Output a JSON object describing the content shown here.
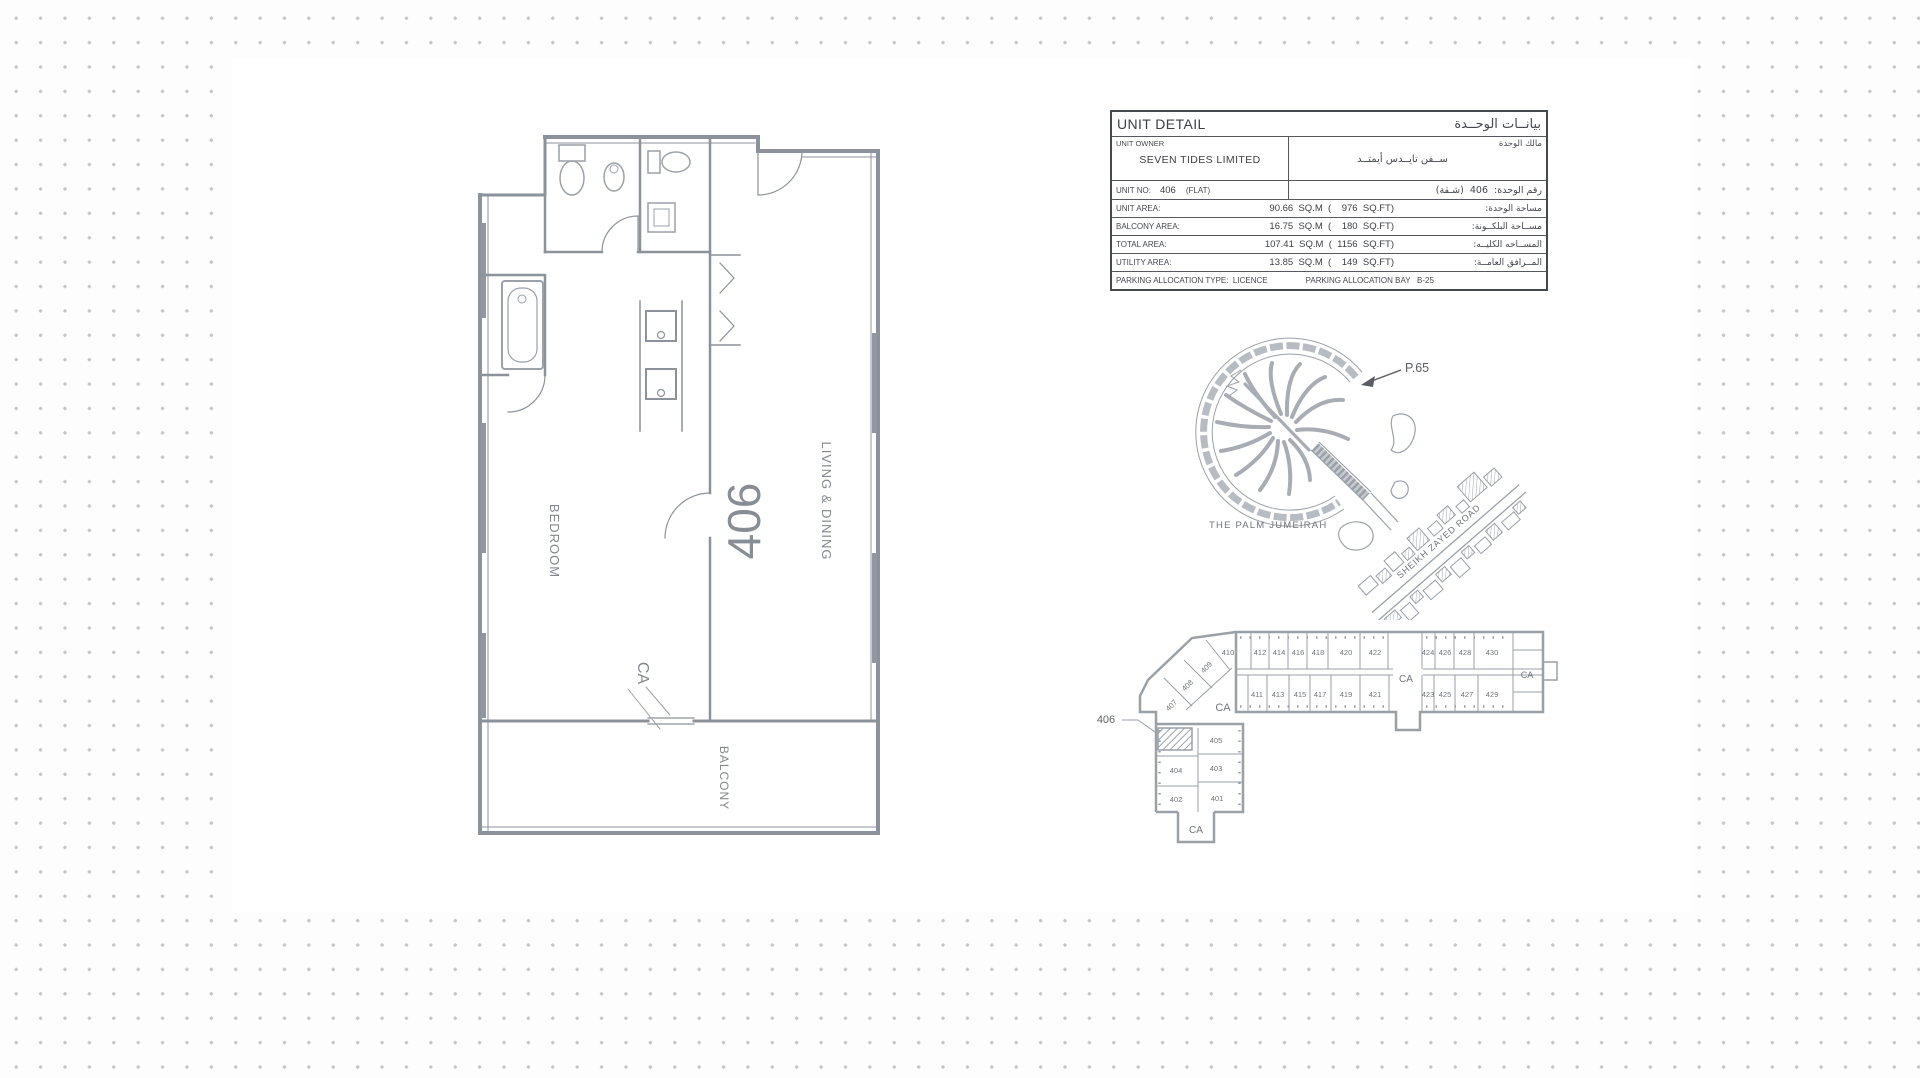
{
  "table": {
    "title_en": "UNIT DETAIL",
    "title_ar": "بيانــات الوحــدة",
    "owner_label_en": "UNIT OWNER",
    "owner_label_ar": "مالك الوحدة",
    "owner_name_en": "SEVEN TIDES LIMITED",
    "owner_name_ar": "ســفن تايــدس أيمتــد",
    "unit_no_label_en": "UNIT NO:",
    "unit_no_value": "406",
    "unit_no_type": "(FLAT)",
    "unit_no_ar": "رقم الوحدة:  406  (شـقة)",
    "area_rows": [
      {
        "label": "UNIT AREA:",
        "value": " 90.66  SQ.M  (    976  SQ.FT)",
        "ar": "مساحة الوحدة:"
      },
      {
        "label": "BALCONY AREA:",
        "value": " 16.75  SQ.M  (    180  SQ.FT)",
        "ar": "مســاحة البلكــونة:"
      },
      {
        "label": "TOTAL AREA:",
        "value": "107.41  SQ.M  (  1156  SQ.FT)",
        "ar": "المســاحه الكليــه:"
      },
      {
        "label": "UTILITY AREA:",
        "value": " 13.85  SQ.M  (    149  SQ.FT)",
        "ar": "المــرافق العامــة:"
      }
    ],
    "parking_left": "PARKING ALLOCATION TYPE:  LICENCE",
    "parking_right": "PARKING ALLOCATION BAY   B-25"
  },
  "floorplan": {
    "bedroom": "BEDROOM",
    "unit_number": "406",
    "living": "LIVING & DINING",
    "ca": "CA",
    "balcony": "BALCONY"
  },
  "map": {
    "marker": "P.65",
    "palm_label": "THE PALM JUMEIRAH",
    "road_label": "SHEIKH ZAYED ROAD"
  },
  "keyplan": {
    "callout": "406",
    "row_top": [
      "410",
      "412",
      "414",
      "416",
      "418",
      "420",
      "422",
      "424",
      "426",
      "428",
      "430"
    ],
    "row_bottom": [
      "411",
      "413",
      "415",
      "417",
      "419",
      "421",
      "423",
      "425",
      "427",
      "429"
    ],
    "diagonal": [
      "409",
      "408",
      "407"
    ],
    "lower": [
      "405",
      "404",
      "403",
      "402",
      "401"
    ],
    "ca_center": "CA",
    "ca_right": "CA",
    "ca_left": "CA",
    "ca_bottom": "CA"
  }
}
